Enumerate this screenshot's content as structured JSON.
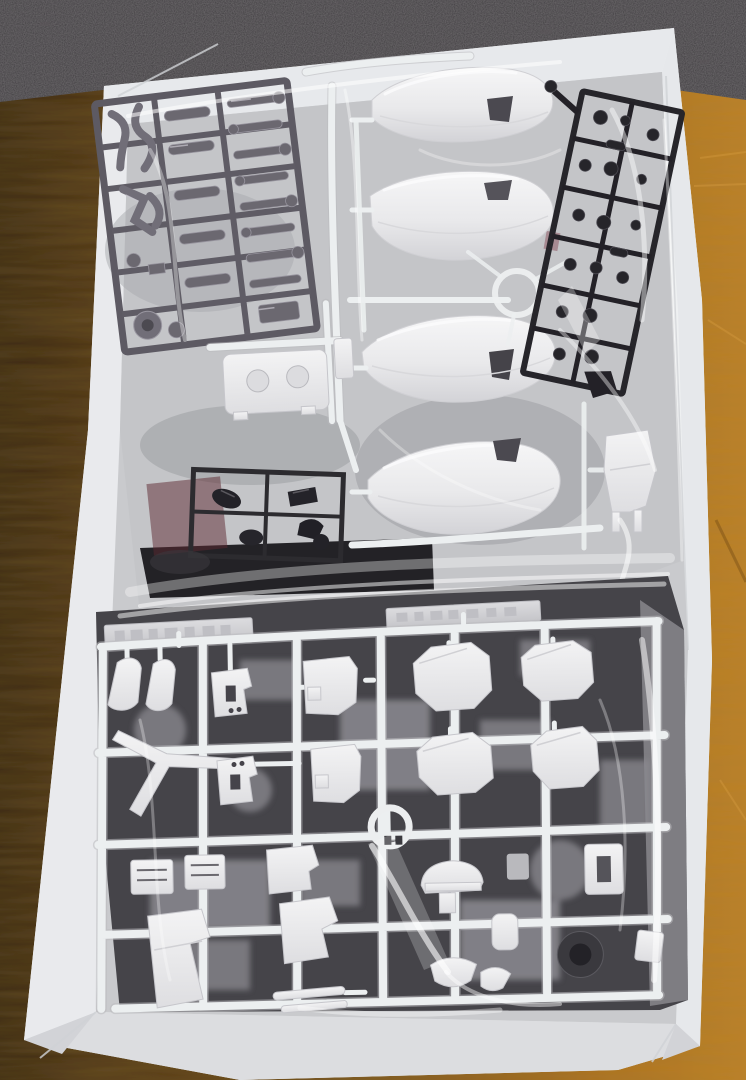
{
  "scene": {
    "type": "photograph",
    "description": "Opened white model-kit box sitting on an orange wooden table in front of dark carpet. Inside are plastic injection sprues (runners) sealed in clear poly bags: a gunmetal inner-frame sprue top-left, a white sprue with four large curved hull/leg armor pieces in the center, a black small-parts sprue top-right, a small black joint sprue and a white connector part in the middle, and one large white armor sprue filling the bottom half with octagonal shoulder plates, a v-fin, a helmet dome, thruster blocks and foot parts over dark parts beneath.",
    "setting": {
      "surface": "wooden table",
      "backdrop": "dark carpet",
      "lighting": "indoor, soft glare on plastic bags"
    },
    "palette": {
      "carpet": "#3a373b",
      "wood_dark": "#3f2c10",
      "wood_mid": "#7b5418",
      "wood_light": "#b5781f",
      "box_white": "#eef0f1",
      "box_wall": "#e7e9ec",
      "box_wall_bottom": "#dcdde0",
      "box_floor": "#c9cacd",
      "bag_gray": "#c3c4c8",
      "under_dark": "#454449",
      "gunmetal": "#5d5a63",
      "sprue_black": "#26252a",
      "part_white": "#edeeef",
      "plate_gray": "#d2d2d6",
      "vent_dark": "#4b4950",
      "maroon": "#5c2830"
    },
    "objects": [
      {
        "name": "cardboard-box",
        "color": "#eef0f1",
        "position": "fills frame, slightly tilted clockwise"
      },
      {
        "name": "gunmetal-frame-sprue",
        "color": "#5d5a63",
        "position": "top-left inside clear bag, tilted"
      },
      {
        "name": "white-hull-sprue",
        "color": "#ececee",
        "position": "top-center, four large curved pieces each with a small dark vent opening"
      },
      {
        "name": "black-polycap-sprue",
        "color": "#26252a",
        "position": "top-right, tilted clockwise"
      },
      {
        "name": "white-connector-part",
        "color": "#e9e9eb",
        "position": "middle-left, small block with two embossed circles"
      },
      {
        "name": "black-joint-sprue",
        "color": "#2c2b2f",
        "position": "center-left below middle"
      },
      {
        "name": "maroon-parts-hint",
        "color": "#5c2830",
        "position": "faintly visible through bag near middle-left"
      },
      {
        "name": "white-leg-part",
        "color": "#e9e9eb",
        "position": "middle-right near box wall"
      },
      {
        "name": "large-white-armor-sprue",
        "color": "#edeeef",
        "position": "bottom half: 4 octagonal shoulder plates, v-fin, slotted foot boxes, helmet dome, thruster blocks, circular gate rings"
      },
      {
        "name": "molded-nameplate-strips",
        "color": "#d2d2d6",
        "position": "two strips along top edge of bottom sprue, embossed illegible text"
      },
      {
        "name": "clear-plastic-bags",
        "color": "rgba(255,255,255,0.45)",
        "position": "wrapping all sprues, wrinkled glare streaks"
      },
      {
        "name": "wooden-table",
        "color": "#b5781f",
        "position": "background, dark at left, bright orange at right"
      },
      {
        "name": "dark-carpet",
        "color": "#3a373b",
        "position": "background strip across the top"
      }
    ],
    "counts": {
      "large_hull_pieces": 4,
      "octagonal_armor_plates": 4,
      "nameplate_strips": 2,
      "circular_gate_rings": 2,
      "sprues_visible": 6
    },
    "text_visible": "none (embossed sprue lettering illegible)"
  }
}
